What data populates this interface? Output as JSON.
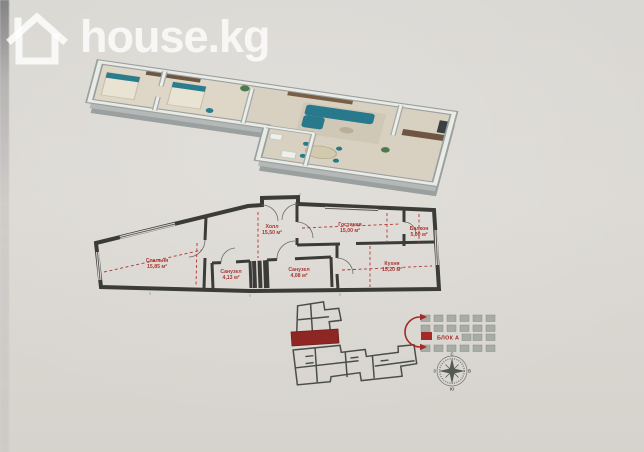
{
  "watermark": {
    "brand": "house.kg"
  },
  "plan2d": {
    "rooms": [
      {
        "name": "Спальня",
        "area": "15,85 м²"
      },
      {
        "name": "Холл",
        "area": "15,50 м²"
      },
      {
        "name": "Гостиная",
        "area": "15,00 м²"
      },
      {
        "name": "Балкон",
        "area": "5,00 м²"
      },
      {
        "name": "Кухня",
        "area": "15,20 м²"
      },
      {
        "name": "Санузел",
        "area": "4,13 м²"
      },
      {
        "name": "Санузел",
        "area": "4,08 м²"
      }
    ]
  },
  "site_plan": {
    "block_label": "БЛОК А"
  },
  "compass": {
    "n": "С",
    "e": "В",
    "s": "Ю",
    "w": "З"
  },
  "colors": {
    "label_red": "#a93632",
    "unit_red": "#8e2724",
    "wall_dark": "#3b3b38",
    "teal": "#2b7d8e",
    "paper": "#dbd8d3"
  }
}
